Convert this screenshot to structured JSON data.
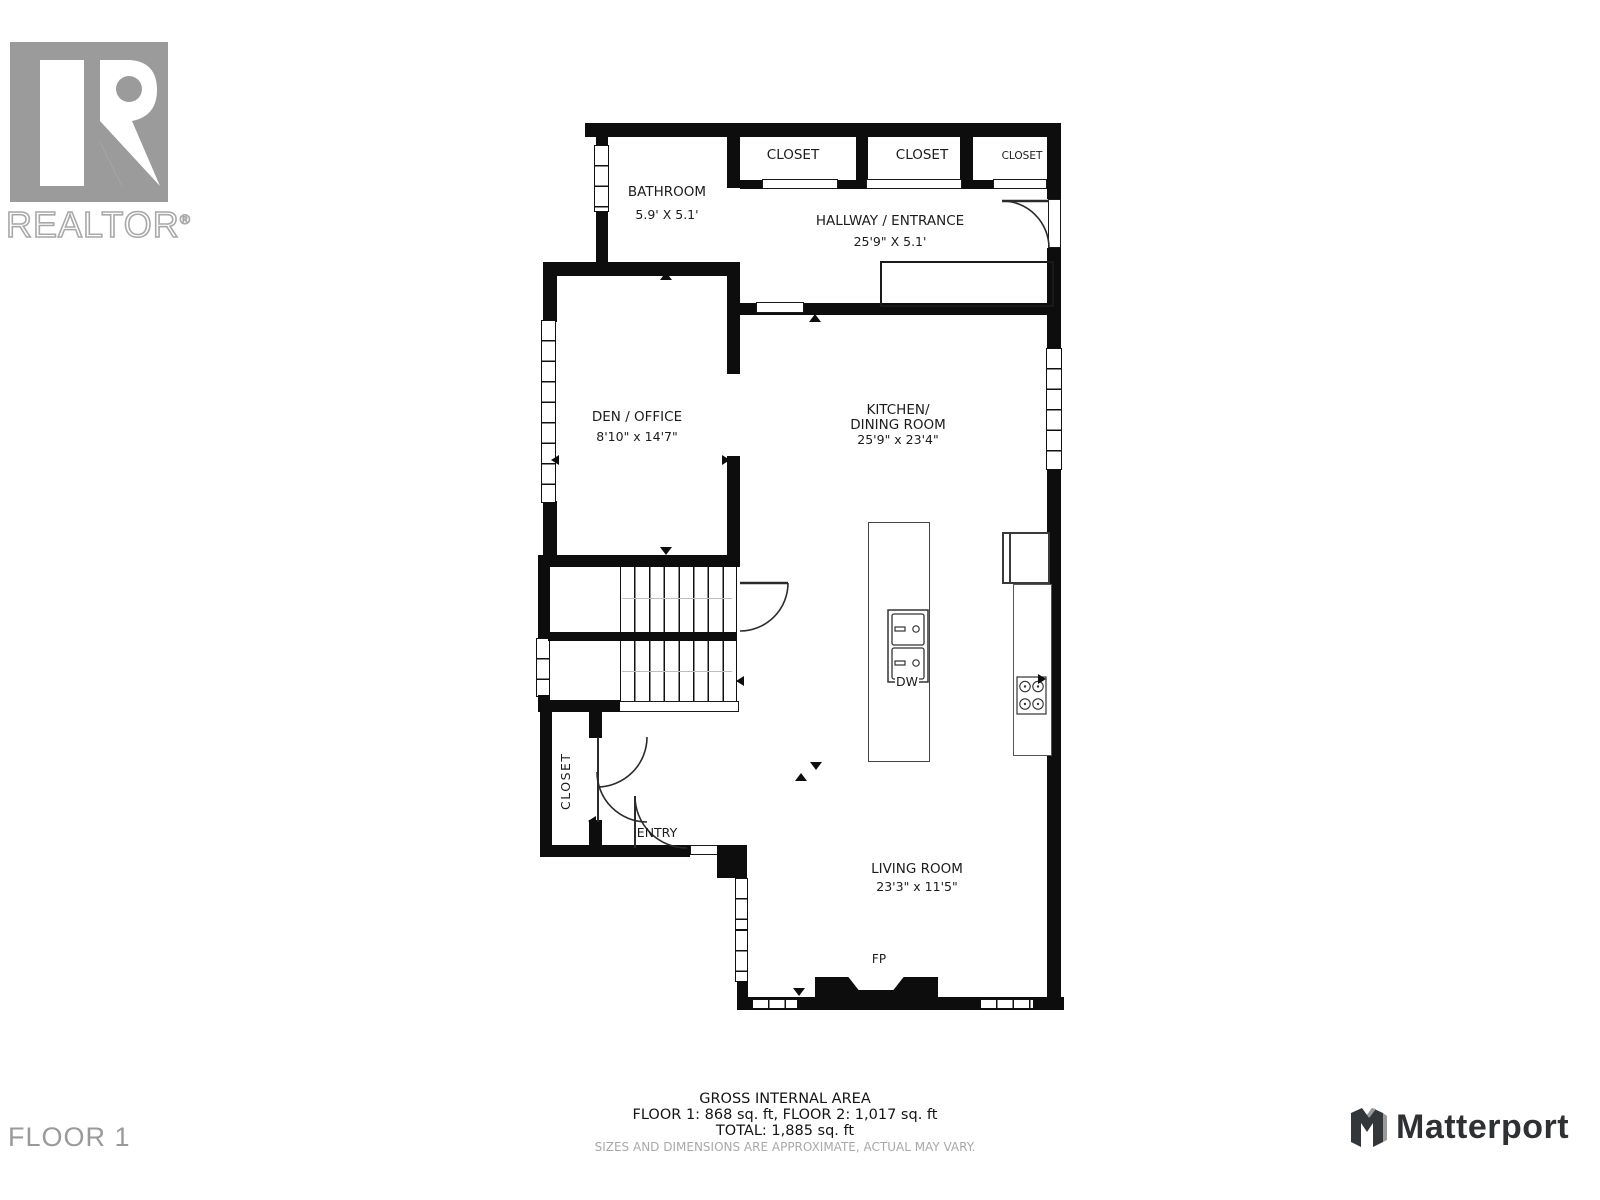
{
  "branding": {
    "realtor_logo": "realtor-block-r",
    "realtor_text": "REALTOR",
    "registered_mark": "®",
    "matterport_text": "Matterport"
  },
  "floor_label": "FLOOR 1",
  "rooms": {
    "bathroom": {
      "name": "BATHROOM",
      "dims": "5.9' X 5.1'"
    },
    "closet_top_1": {
      "name": "CLOSET"
    },
    "closet_top_2": {
      "name": "CLOSET"
    },
    "closet_top_3": {
      "name": "CLOSET"
    },
    "hallway": {
      "name": "HALLWAY / ENTRANCE",
      "dims": "25'9\" X 5.1'"
    },
    "den": {
      "name": "DEN / OFFICE",
      "dims": "8'10\" x 14'7\""
    },
    "kitchen": {
      "name_line1": "KITCHEN/",
      "name_line2": "DINING ROOM",
      "dims": "25'9\" x 23'4\""
    },
    "living": {
      "name": "LIVING ROOM",
      "dims": "23'3\" x 11'5\""
    },
    "entry_closet": {
      "name": "CLOSET"
    },
    "entry": {
      "name": "ENTRY"
    }
  },
  "fixtures": {
    "fireplace": "FP",
    "dishwasher": "DW"
  },
  "footer": {
    "area_title": "GROSS INTERNAL AREA",
    "area_line1": "FLOOR 1: 868 sq. ft, FLOOR 2: 1,017 sq. ft",
    "area_line2": "TOTAL: 1,885 sq. ft",
    "disclaimer": "SIZES AND DIMENSIONS ARE APPROXIMATE, ACTUAL MAY VARY."
  },
  "colors": {
    "wall": "#0d0d0d",
    "brand_gray": "#9b9b9b",
    "matterport_dark": "#2e3134"
  }
}
